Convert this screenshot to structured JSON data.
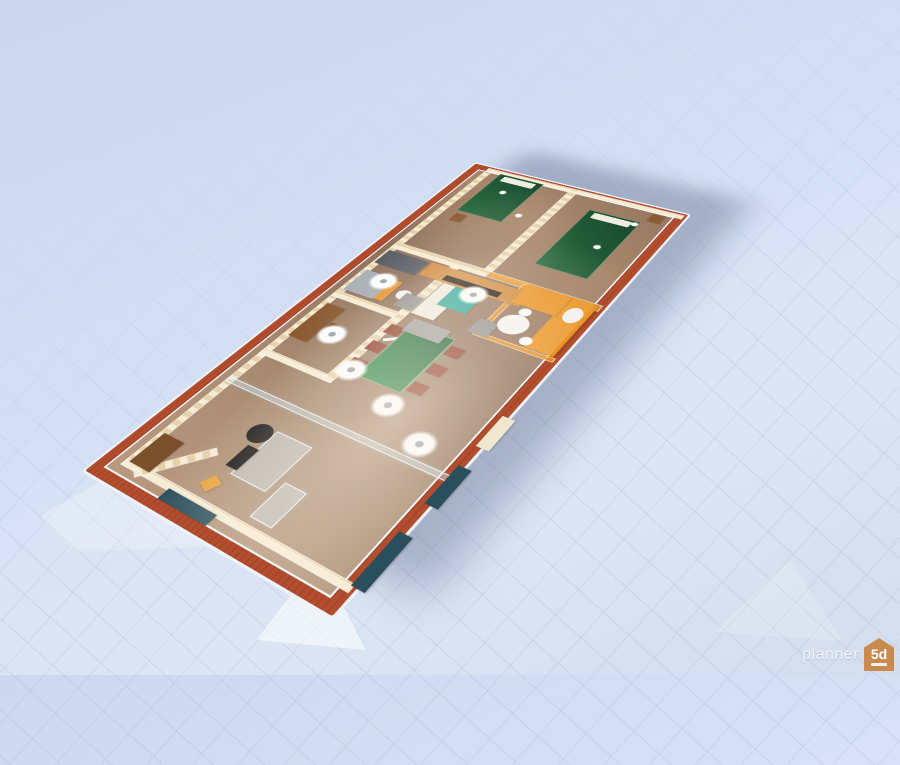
{
  "watermark": {
    "brand": "planner",
    "logo_text": "5d"
  },
  "colors": {
    "bg_top": "#ccd8f0",
    "bg_mid": "#d8e2f4",
    "bg_bottom": "#d3ddee",
    "grid_line": "#97a8c8",
    "wall_red": "#b24e2e",
    "wall_red_dark": "#9d4426",
    "wallpaper_light": "#f7ecd4",
    "wallpaper_dark": "#e7d1a6",
    "floor_mid": "#a5876d",
    "bed_green": "#1d5a33",
    "table_green": "#1f7a40",
    "chair_red": "#8b3726",
    "tv_stand_orange": "#d08a3e",
    "kitchen_orange": "#ea9426",
    "teal": "#2aa79b",
    "glass_blue": "#cde2f0",
    "window_glass_dark": "#2a4e5c",
    "watermark_orange": "#c98a50",
    "shadow": "rgba(82,95,130,0.38)"
  },
  "scene": {
    "items": [
      {
        "name": "wallpaper-lining-top",
        "type": "wall",
        "x": 12,
        "y": 12,
        "w": 636,
        "h": 8
      },
      {
        "name": "wallpaper-lining-left",
        "type": "wall",
        "x": 12,
        "y": 12,
        "w": 8,
        "h": 276
      },
      {
        "name": "wallpaper-lining-right",
        "type": "wall",
        "x": 640,
        "y": 12,
        "w": 8,
        "h": 276
      },
      {
        "name": "study-left-wall",
        "type": "wall",
        "x": 200,
        "y": 12,
        "w": 8,
        "h": 98
      },
      {
        "name": "study-bath-wall",
        "type": "wall",
        "x": 318,
        "y": 12,
        "w": 10,
        "h": 98
      },
      {
        "name": "study-bath-bottom-wall",
        "type": "wall",
        "x": 200,
        "y": 100,
        "w": 230,
        "h": 10
      },
      {
        "name": "bedroom-cross-wall",
        "type": "wall",
        "x": 430,
        "y": 12,
        "w": 12,
        "h": 134
      },
      {
        "name": "balustrade-wall",
        "type": "orange-wall rail",
        "x": 430,
        "y": 146,
        "w": 12,
        "h": 142
      },
      {
        "name": "bedroom-divider-wall",
        "type": "wall",
        "x": 442,
        "y": 138,
        "w": 206,
        "h": 10
      },
      {
        "name": "office-glass-partition",
        "type": "glass",
        "x": 148,
        "y": 12,
        "w": 8,
        "h": 276
      },
      {
        "name": "hall-angled-wall",
        "type": "wall",
        "x": 2,
        "y": 52,
        "w": 76,
        "h": 9,
        "rot": 38
      },
      {
        "name": "kitchen-partition-vertical",
        "type": "orange-glass",
        "x": 334,
        "y": 192,
        "w": 7,
        "h": 96
      },
      {
        "name": "kitchen-partition-horizontal",
        "type": "orange-glass",
        "x": 334,
        "y": 192,
        "w": 104,
        "h": 7
      },
      {
        "name": "office-closet",
        "type": "block",
        "x": 18,
        "y": 16,
        "w": 44,
        "h": 28,
        "color": "#7a4f2c"
      },
      {
        "name": "orange-wedge-decor",
        "type": "block",
        "x": 30,
        "y": 98,
        "w": 16,
        "h": 14,
        "color": "#e8a13c",
        "rot": 25
      },
      {
        "name": "office-glass-desk",
        "type": "glass",
        "x": 56,
        "y": 112,
        "w": 64,
        "h": 44
      },
      {
        "name": "office-monitor",
        "type": "block",
        "x": 62,
        "y": 100,
        "w": 30,
        "h": 14,
        "color": "#151515"
      },
      {
        "name": "office-chair",
        "type": "round",
        "x": 96,
        "y": 86,
        "w": 26,
        "h": 26,
        "color": "#1a1a1a"
      },
      {
        "name": "office-side-table",
        "type": "glass",
        "x": 28,
        "y": 164,
        "w": 46,
        "h": 26
      },
      {
        "name": "study-desk",
        "type": "block",
        "x": 238,
        "y": 18,
        "w": 66,
        "h": 26,
        "color": "#8a5a33"
      },
      {
        "name": "study-chair",
        "type": "block",
        "x": 260,
        "y": 46,
        "w": 18,
        "h": 16,
        "color": "#7a4f2c"
      },
      {
        "name": "bath-shower",
        "type": "block",
        "x": 334,
        "y": 16,
        "w": 44,
        "h": 42,
        "color": "#a7aeb5"
      },
      {
        "name": "bath-shower-front-panel",
        "type": "block",
        "x": 336,
        "y": 58,
        "w": 40,
        "h": 12,
        "color": "#e8952f"
      },
      {
        "name": "bath-tall-cabinet",
        "type": "block",
        "x": 394,
        "y": 14,
        "w": 30,
        "h": 58,
        "color": "#565c63"
      },
      {
        "name": "bath-toilet",
        "type": "round",
        "x": 348,
        "y": 76,
        "w": 18,
        "h": 18,
        "color": "#f3f3f1"
      },
      {
        "name": "fridge-wardrobe",
        "type": "block",
        "x": 334,
        "y": 112,
        "w": 64,
        "h": 30,
        "color": "#edebe3"
      },
      {
        "name": "open-door-leaf",
        "type": "door-leaf",
        "x": 292,
        "y": 110,
        "w": 5,
        "h": 44,
        "rot": -38
      },
      {
        "name": "dining-floor-glow",
        "type": "glow",
        "x": 224,
        "y": 150,
        "w": 96,
        "h": 44
      },
      {
        "name": "dining-table",
        "type": "table-green",
        "x": 222,
        "y": 126,
        "w": 96,
        "h": 56
      },
      {
        "name": "dining-chair-1",
        "type": "block",
        "x": 228,
        "y": 106,
        "w": 16,
        "h": 18,
        "color": "#8b3726"
      },
      {
        "name": "dining-chair-2",
        "type": "block",
        "x": 260,
        "y": 106,
        "w": 16,
        "h": 18,
        "color": "#8b3726"
      },
      {
        "name": "dining-chair-3",
        "type": "block",
        "x": 292,
        "y": 106,
        "w": 16,
        "h": 18,
        "color": "#8b3726"
      },
      {
        "name": "dining-chair-4",
        "type": "block",
        "x": 228,
        "y": 184,
        "w": 16,
        "h": 18,
        "color": "#8b3726"
      },
      {
        "name": "dining-chair-5",
        "type": "block",
        "x": 260,
        "y": 184,
        "w": 16,
        "h": 18,
        "color": "#8b3726"
      },
      {
        "name": "dining-chair-6",
        "type": "block",
        "x": 292,
        "y": 184,
        "w": 16,
        "h": 18,
        "color": "#8b3726"
      },
      {
        "name": "gray-sofa",
        "type": "block",
        "x": 304,
        "y": 122,
        "w": 24,
        "h": 48,
        "color": "#9c9c9c"
      },
      {
        "name": "gray-armchair-1",
        "type": "block",
        "x": 336,
        "y": 86,
        "w": 26,
        "h": 24,
        "color": "#8f8f8f"
      },
      {
        "name": "gray-armchair-2",
        "type": "block",
        "x": 336,
        "y": 184,
        "w": 26,
        "h": 24,
        "color": "#8f8f8f"
      },
      {
        "name": "teal-ottoman",
        "type": "block",
        "x": 360,
        "y": 128,
        "w": 42,
        "h": 38,
        "color": "#2aa79b"
      },
      {
        "name": "tv-stand",
        "type": "block",
        "x": 398,
        "y": 76,
        "w": 28,
        "h": 134,
        "color": "#d08a3e"
      },
      {
        "name": "tv",
        "type": "block",
        "x": 402,
        "y": 106,
        "w": 10,
        "h": 74,
        "color": "#20160f"
      },
      {
        "name": "kitchen-cabinet-bottom",
        "type": "block",
        "x": 342,
        "y": 250,
        "w": 98,
        "h": 34,
        "color": "#ea9426"
      },
      {
        "name": "kitchen-cabinet-right",
        "type": "block",
        "x": 402,
        "y": 198,
        "w": 38,
        "h": 54,
        "color": "#ea9426"
      },
      {
        "name": "kitchen-round-table",
        "type": "round",
        "x": 352,
        "y": 204,
        "w": 34,
        "h": 34,
        "color": "#f5f5f3"
      },
      {
        "name": "kitchen-chair-1",
        "type": "round",
        "x": 344,
        "y": 240,
        "w": 14,
        "h": 14,
        "color": "#fafafa"
      },
      {
        "name": "kitchen-chair-2",
        "type": "round",
        "x": 386,
        "y": 214,
        "w": 14,
        "h": 14,
        "color": "#fafafa"
      },
      {
        "name": "kitchen-white-seat",
        "type": "round",
        "x": 398,
        "y": 258,
        "w": 28,
        "h": 20,
        "color": "#f2f2f0"
      },
      {
        "name": "bed-bedroom-a",
        "type": "bed",
        "x": 538,
        "y": 34,
        "w": 104,
        "h": 66
      },
      {
        "name": "nightstand-bedroom-a",
        "type": "block",
        "x": 514,
        "y": 38,
        "w": 18,
        "h": 16,
        "color": "#8a5a33"
      },
      {
        "name": "bed-bedroom-b",
        "type": "bed",
        "x": 478,
        "y": 182,
        "w": 134,
        "h": 68
      },
      {
        "name": "nightstand-bedroom-b",
        "type": "block",
        "x": 618,
        "y": 254,
        "w": 18,
        "h": 16,
        "color": "#8a5a33"
      },
      {
        "name": "ceiling-light-hall",
        "type": "light-disc",
        "x": 156,
        "y": 222,
        "w": 36,
        "h": 36
      },
      {
        "name": "ceiling-light-dining-1",
        "type": "light-disc",
        "x": 208,
        "y": 98,
        "w": 36,
        "h": 36
      },
      {
        "name": "ceiling-light-dining-2",
        "type": "light-disc",
        "x": 184,
        "y": 164,
        "w": 36,
        "h": 36
      },
      {
        "name": "ceiling-light-study",
        "type": "light-disc",
        "x": 244,
        "y": 42,
        "w": 36,
        "h": 36
      },
      {
        "name": "ceiling-light-bath",
        "type": "light-disc",
        "x": 350,
        "y": 30,
        "w": 36,
        "h": 36
      },
      {
        "name": "ceiling-light-living",
        "type": "light-disc",
        "x": 376,
        "y": 136,
        "w": 36,
        "h": 36
      },
      {
        "name": "pendant-bedroom-a-1",
        "type": "pendant",
        "x": 596,
        "y": 58,
        "w": 10,
        "h": 10
      },
      {
        "name": "pendant-bedroom-a-2",
        "type": "pendant",
        "x": 556,
        "y": 106,
        "w": 10,
        "h": 10
      },
      {
        "name": "pendant-bedroom-b-1",
        "type": "pendant",
        "x": 536,
        "y": 224,
        "w": 10,
        "h": 10
      },
      {
        "name": "pendant-bedroom-b-2",
        "type": "pendant",
        "x": 600,
        "y": 240,
        "w": 10,
        "h": 10
      },
      {
        "name": "window-southwest-1",
        "type": "block",
        "x": 18,
        "y": 286,
        "w": 64,
        "h": 14,
        "color": "#2a4e5c"
      },
      {
        "name": "window-southwest-2",
        "type": "block",
        "x": 118,
        "y": 286,
        "w": 52,
        "h": 14,
        "color": "#2a4e5c"
      },
      {
        "name": "entry-door-southwest",
        "type": "block",
        "x": 198,
        "y": 286,
        "w": 46,
        "h": 14,
        "color": "#efe7cf"
      },
      {
        "name": "window-west",
        "type": "block",
        "x": 0,
        "y": 76,
        "w": 14,
        "h": 62,
        "color": "#2a4e5c"
      }
    ]
  }
}
